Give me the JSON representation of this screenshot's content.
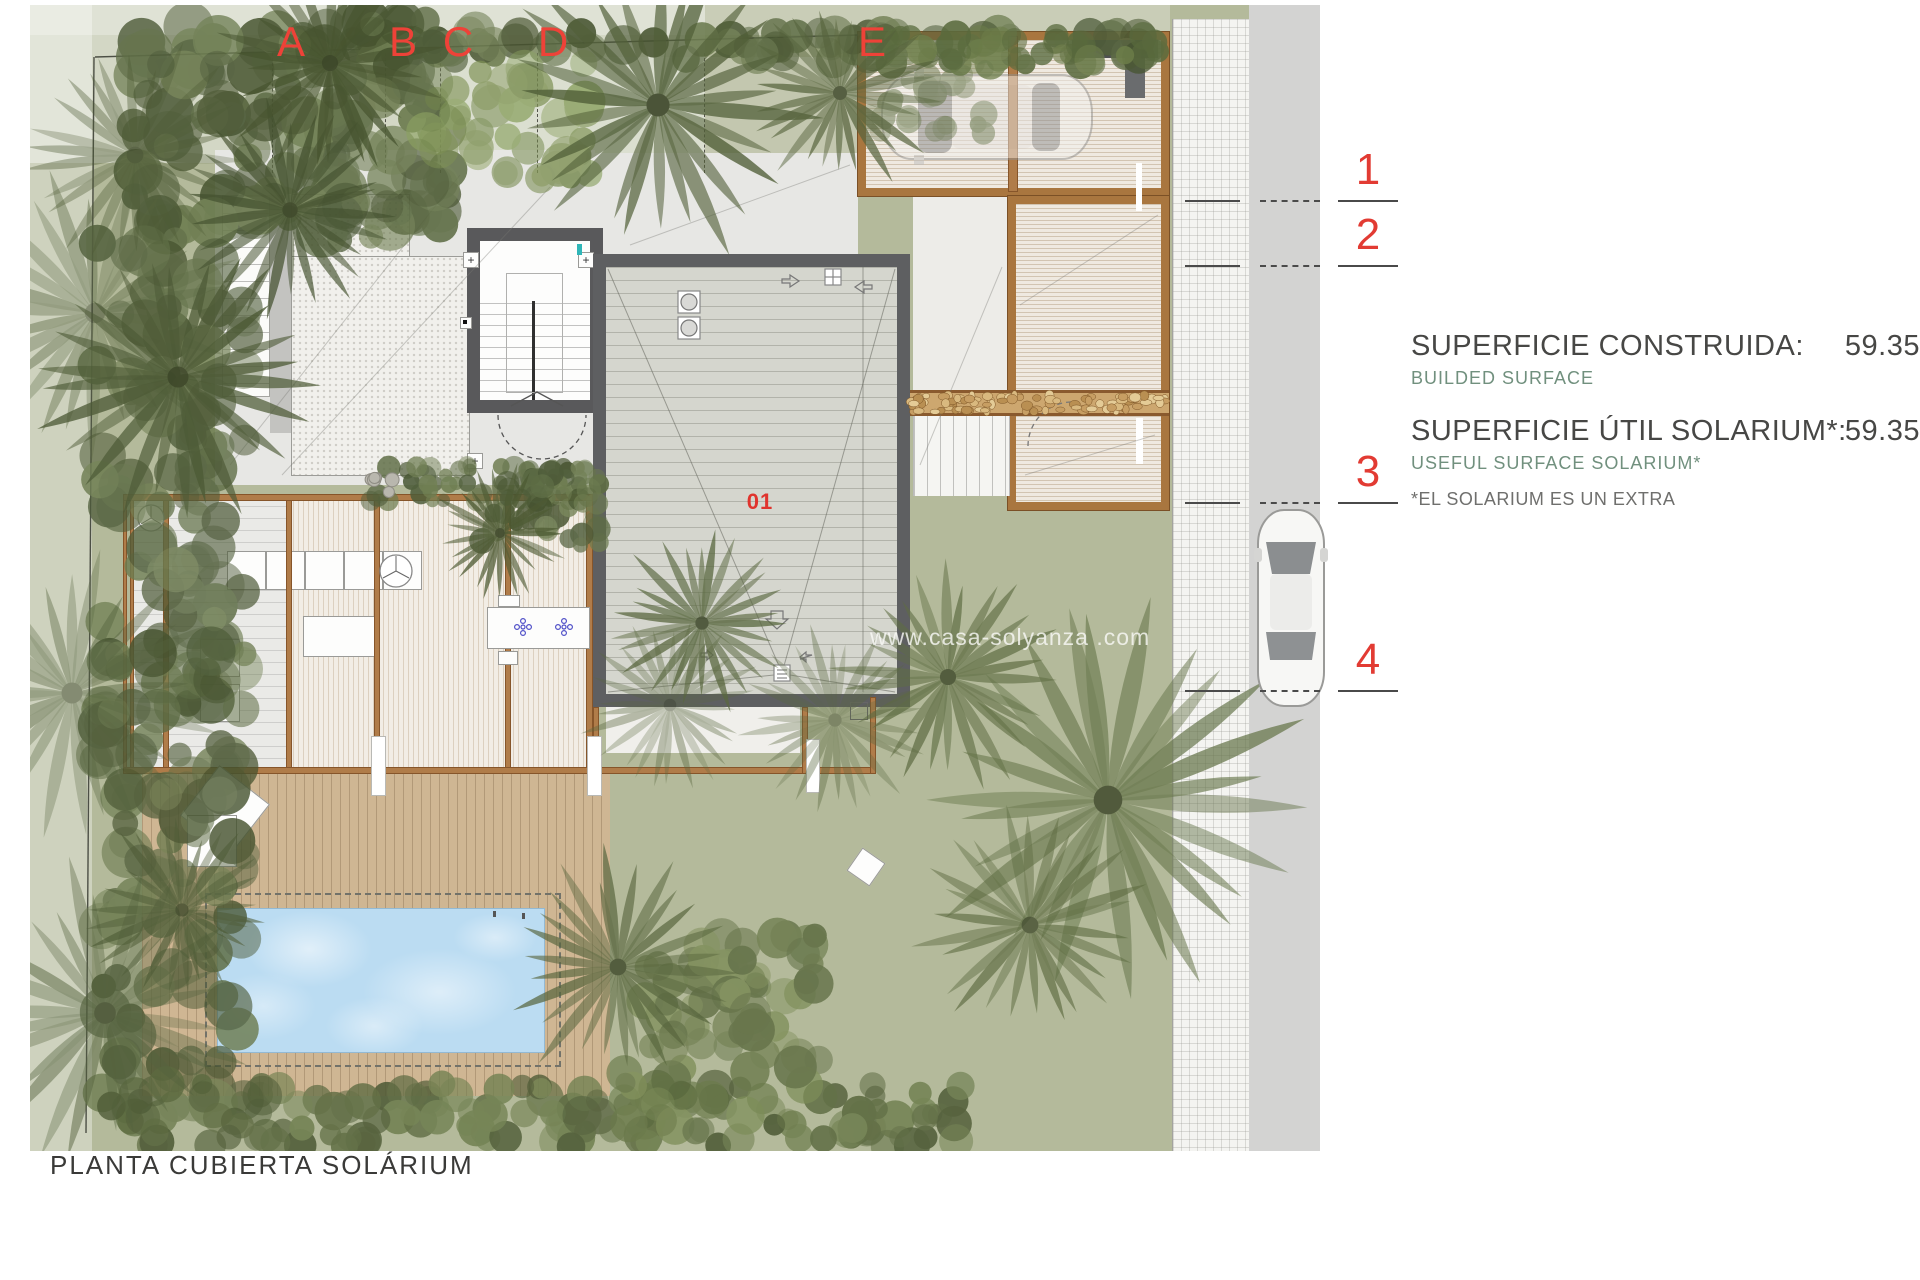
{
  "plan": {
    "label": "PLANTA CUBIERTA SOLÁRIUM",
    "deck_unit_label": "01",
    "watermark": "www.casa-solyanza .com",
    "grid": {
      "letters": [
        "A",
        "B",
        "C",
        "D",
        "E"
      ],
      "numbers": [
        "1",
        "2",
        "3",
        "4"
      ]
    }
  },
  "legend": {
    "rows": [
      {
        "label": "SUPERFICIE CONSTRUIDA:",
        "sub": "BUILDED SURFACE",
        "value": "59.35"
      },
      {
        "label": "SUPERFICIE ÚTIL SOLARIUM*:",
        "sub": "USEFUL SURFACE SOLARIUM*",
        "value": "59.35"
      }
    ],
    "note": "*EL SOLARIUM ES UN EXTRA",
    "colors": {
      "grid_red": "#ee4238",
      "accent_green": "#71907e",
      "text_dark": "#474745"
    }
  }
}
